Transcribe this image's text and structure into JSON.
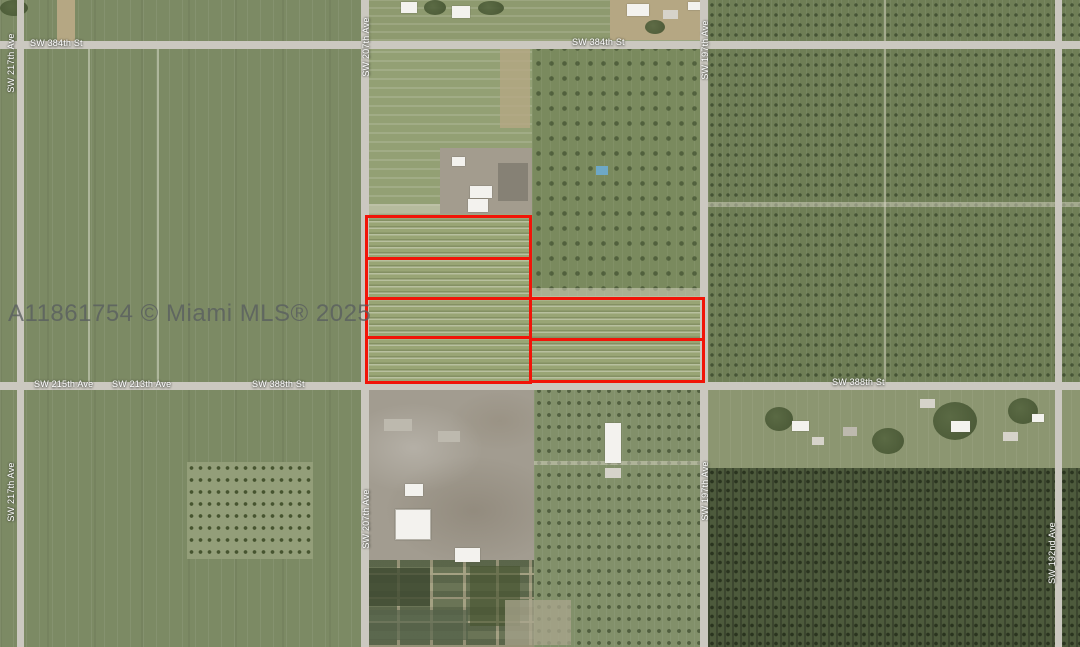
{
  "map": {
    "watermark": "A11861754 © Miami MLS® 2025",
    "street_labels": [
      {
        "text": "SW 384th St",
        "orientation": "horizontal"
      },
      {
        "text": "SW 384th St",
        "orientation": "horizontal"
      },
      {
        "text": "SW 215th Ave",
        "orientation": "horizontal"
      },
      {
        "text": "SW 213th Ave",
        "orientation": "horizontal"
      },
      {
        "text": "SW 388th St",
        "orientation": "horizontal"
      },
      {
        "text": "SW 388th St",
        "orientation": "horizontal"
      },
      {
        "text": "SW 217th Ave",
        "orientation": "vertical"
      },
      {
        "text": "SW 217th Ave",
        "orientation": "vertical"
      },
      {
        "text": "SW 207th Ave",
        "orientation": "vertical"
      },
      {
        "text": "SW 207th Ave",
        "orientation": "vertical"
      },
      {
        "text": "SW 197th Ave",
        "orientation": "vertical"
      },
      {
        "text": "SW 197th Ave",
        "orientation": "vertical"
      },
      {
        "text": "SW 192nd Ave",
        "orientation": "vertical"
      }
    ],
    "parcels": [
      {
        "x": 365,
        "y": 215,
        "w": 167,
        "h": 45
      },
      {
        "x": 365,
        "y": 257,
        "w": 167,
        "h": 43
      },
      {
        "x": 365,
        "y": 297,
        "w": 167,
        "h": 42
      },
      {
        "x": 365,
        "y": 336,
        "w": 167,
        "h": 48
      },
      {
        "x": 529,
        "y": 297,
        "w": 176,
        "h": 44
      },
      {
        "x": 529,
        "y": 338,
        "w": 176,
        "h": 45
      }
    ],
    "colors": {
      "parcel_outline": "#f11408",
      "road": "#cbc8c0",
      "watermark_gray": "#5f6466"
    }
  }
}
